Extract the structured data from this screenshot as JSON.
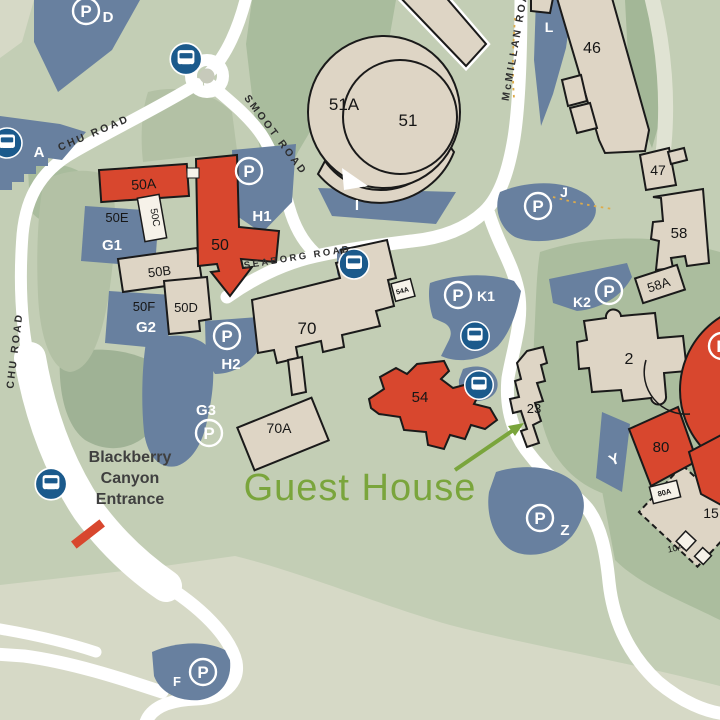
{
  "map": {
    "road_labels": {
      "chu_top": "CHU ROAD",
      "chu_left": "CHU ROAD",
      "smoot": "SMOOT ROAD",
      "seaborg": "SEABORG ROAD",
      "mcmillan": "McMILLAN ROAD"
    },
    "buildings": {
      "b51a": "51A",
      "b51": "51",
      "b46": "46",
      "b47": "47",
      "b58": "58",
      "b58a": "58A",
      "b2": "2",
      "b23": "23",
      "b70": "70",
      "b70a": "70A",
      "b50": "50",
      "b50a": "50A",
      "b50b": "50B",
      "b50c": "50C",
      "b50d": "50D",
      "b50e": "50E",
      "b50f": "50F",
      "b54": "54",
      "b54a": "54A",
      "b80": "80",
      "b80a": "80A",
      "b15": "15",
      "b10a": "10A"
    },
    "parking": {
      "symbol": "P",
      "d": "D",
      "a": "A",
      "f": "F",
      "i": "I",
      "j": "J",
      "l": "L",
      "y": "Y",
      "z": "Z",
      "g1": "G1",
      "g2": "G2",
      "g3": "G3",
      "h1": "H1",
      "h2": "H2",
      "k1": "K1",
      "k2": "K2"
    },
    "annotations": {
      "guest_house": "Guest House",
      "entrance_line1": "Blackberry",
      "entrance_line2": "Canyon",
      "entrance_line3": "Entrance"
    },
    "colors": {
      "base_green": "#c3ceb5",
      "light_green": "#d6d9c6",
      "dark_green": "#a9bc9d",
      "slope_green": "#9fb295",
      "parking_blue": "#68809f",
      "bus_blue": "#1b5a8c",
      "road_white": "#ffffff",
      "building_beige": "#ded5c5",
      "building_red": "#d8472e",
      "building_white": "#f6f2e9",
      "outline_black": "#1a1a1a",
      "guest_green": "#7aa53c",
      "gate_red": "#d8472e",
      "trail_orange": "#ddab4a"
    }
  }
}
